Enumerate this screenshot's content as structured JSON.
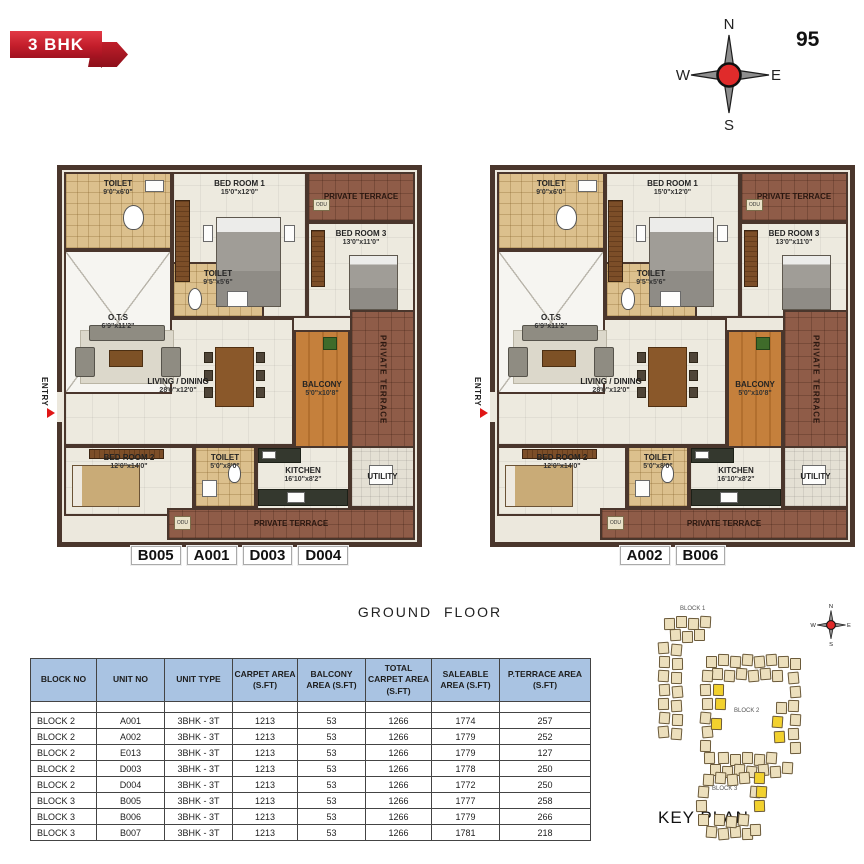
{
  "ribbon": {
    "label": "3 BHK"
  },
  "page_number": "95",
  "compass": {
    "north": "N",
    "east": "E",
    "south": "S",
    "west": "W"
  },
  "ground_floor_label": "GROUND  FLOOR",
  "floor_plan": {
    "entry_label": "ENTRY",
    "odu_label": "ODU",
    "rooms": [
      {
        "id": "living",
        "label": "LIVING / DINING",
        "dims": "28'0\"x12'0\"",
        "type": "living"
      },
      {
        "id": "bedroom1",
        "label": "BED ROOM 1",
        "dims": "15'0\"x12'0\"",
        "type": "bedroom"
      },
      {
        "id": "toilet1",
        "label": "TOILET",
        "dims": "9'0\"x6'0\"",
        "type": "toilet"
      },
      {
        "id": "terrace_top",
        "label": "PRIVATE TERRACE",
        "dims": "",
        "type": "terrace"
      },
      {
        "id": "bedroom3",
        "label": "BED ROOM 3",
        "dims": "13'0\"x11'0\"",
        "type": "bedroom"
      },
      {
        "id": "ots",
        "label": "O.T.S",
        "dims": "6'9\"x11'2\"",
        "type": "ots"
      },
      {
        "id": "toilet2",
        "label": "TOILET",
        "dims": "9'5\"x5'6\"",
        "type": "toilet"
      },
      {
        "id": "balcony",
        "label": "BALCONY",
        "dims": "5'0\"x10'8\"",
        "type": "balcony"
      },
      {
        "id": "terrace_right",
        "label": "PRIVATE TERRACE",
        "dims": "",
        "type": "terrace"
      },
      {
        "id": "bedroom2",
        "label": "BED ROOM 2",
        "dims": "12'0\"x14'0\"",
        "type": "bedroom"
      },
      {
        "id": "toilet3",
        "label": "TOILET",
        "dims": "5'0\"x8'0\"",
        "type": "toilet"
      },
      {
        "id": "kitchen",
        "label": "KITCHEN",
        "dims": "16'10\"x8'2\"",
        "type": "kitchen"
      },
      {
        "id": "utility",
        "label": "UTILITY",
        "dims": "",
        "type": "utility"
      },
      {
        "id": "terrace_bottom",
        "label": "PRIVATE TERRACE",
        "dims": "",
        "type": "terrace"
      }
    ],
    "plans": [
      {
        "unit_tags": [
          "B005",
          "A001",
          "D003",
          "D004"
        ]
      },
      {
        "unit_tags": [
          "A002",
          "B006"
        ]
      }
    ]
  },
  "table": {
    "headers": [
      "BLOCK NO",
      "UNIT NO",
      "UNIT TYPE",
      "CARPET AREA (S.FT)",
      "BALCONY AREA (S.FT)",
      "TOTAL CARPET AREA (S.FT)",
      "SALEABLE AREA (S.FT)",
      "P.TERRACE AREA (S.FT)"
    ],
    "rows": [
      [
        "BLOCK 2",
        "A001",
        "3BHK - 3T",
        "1213",
        "53",
        "1266",
        "1774",
        "257"
      ],
      [
        "BLOCK 2",
        "A002",
        "3BHK - 3T",
        "1213",
        "53",
        "1266",
        "1779",
        "252"
      ],
      [
        "BLOCK 2",
        "E013",
        "3BHK - 3T",
        "1213",
        "53",
        "1266",
        "1779",
        "127"
      ],
      [
        "BLOCK 2",
        "D003",
        "3BHK - 3T",
        "1213",
        "53",
        "1266",
        "1778",
        "250"
      ],
      [
        "BLOCK 2",
        "D004",
        "3BHK - 3T",
        "1213",
        "53",
        "1266",
        "1772",
        "250"
      ],
      [
        "BLOCK 3",
        "B005",
        "3BHK - 3T",
        "1213",
        "53",
        "1266",
        "1777",
        "258"
      ],
      [
        "BLOCK 3",
        "B006",
        "3BHK - 3T",
        "1213",
        "53",
        "1266",
        "1779",
        "266"
      ],
      [
        "BLOCK 3",
        "B007",
        "3BHK - 3T",
        "1213",
        "53",
        "1266",
        "1781",
        "218"
      ]
    ]
  },
  "key_plan": {
    "title": "KEY PLAN",
    "block_labels": [
      "BLOCK 1",
      "BLOCK 2",
      "BLOCK 3"
    ]
  },
  "colors": {
    "accent_red": "#c8202c",
    "header_blue": "#a9c3e2",
    "highlight_yellow": "#f2d12e",
    "wall_brown": "#4a362c",
    "terrace_brick": "#8f5c48"
  }
}
